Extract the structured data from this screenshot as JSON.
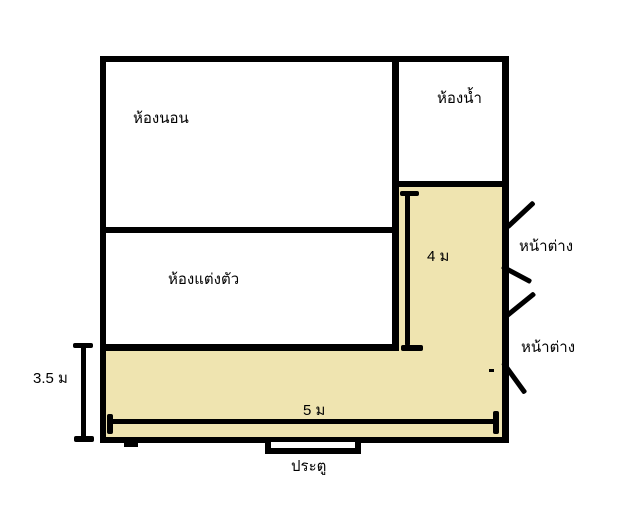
{
  "colors": {
    "background": "#ffffff",
    "wall": "#000000",
    "corridor_fill": "#efe4b0"
  },
  "rooms": {
    "bedroom": {
      "label": "ห้องนอน"
    },
    "bathroom": {
      "label": "ห้องน้ำ"
    },
    "dressing_room": {
      "label": "ห้องแต่งตัว"
    }
  },
  "windows": {
    "top": {
      "label": "หน้าต่าง"
    },
    "bottom": {
      "label": "หน้าต่าง"
    }
  },
  "door": {
    "label": "ประตู"
  },
  "dimensions": {
    "corridor_vertical_length": "4 ม",
    "corridor_bottom_height": "3.5 ม",
    "corridor_bottom_width": "5 ม"
  }
}
